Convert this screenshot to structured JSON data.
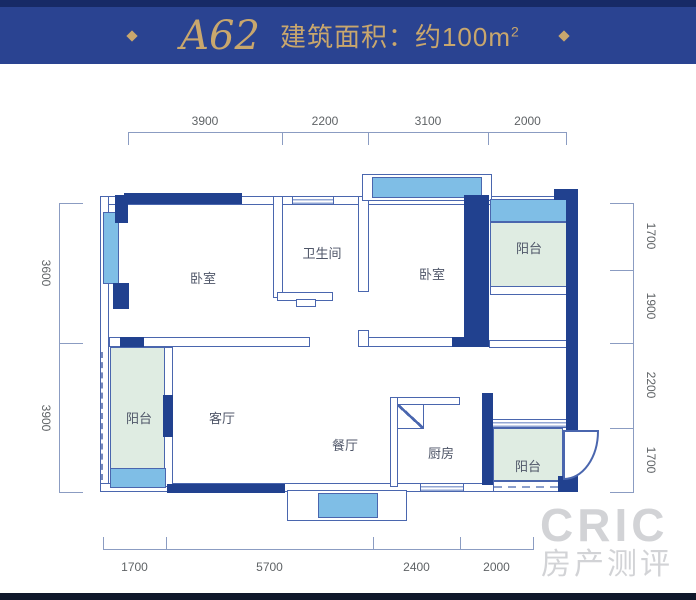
{
  "header": {
    "unit_name": "A62",
    "area_label": "建筑面积：约100m",
    "area_sup": "2"
  },
  "rooms": {
    "bedroom_left": {
      "label": "卧室"
    },
    "bathroom": {
      "label": "卫生间"
    },
    "bedroom_right": {
      "label": "卧室"
    },
    "balcony_top_right": {
      "label": "阳台"
    },
    "balcony_left": {
      "label": "阳台"
    },
    "living": {
      "label": "客厅"
    },
    "dining": {
      "label": "餐厅"
    },
    "kitchen": {
      "label": "厨房"
    },
    "balcony_bottom_right": {
      "label": "阳台"
    }
  },
  "dims": {
    "top": [
      "3900",
      "2200",
      "3100",
      "2000"
    ],
    "bottom": [
      "1700",
      "5700",
      "2400",
      "2000"
    ],
    "left": [
      "3600",
      "3900"
    ],
    "right": [
      "1700",
      "1900",
      "2200",
      "1700"
    ]
  },
  "watermark": {
    "line1": "CRIC",
    "line2": "房产测评"
  },
  "colors": {
    "banner_bg": "#2a4391",
    "banner_gold": "#c9a76d",
    "wall_navy": "#21418f",
    "wall_outline": "#4a66ae",
    "window_blue": "#7fbee6",
    "balcony_green": "#dfece2",
    "dim_text": "#5f6366"
  }
}
